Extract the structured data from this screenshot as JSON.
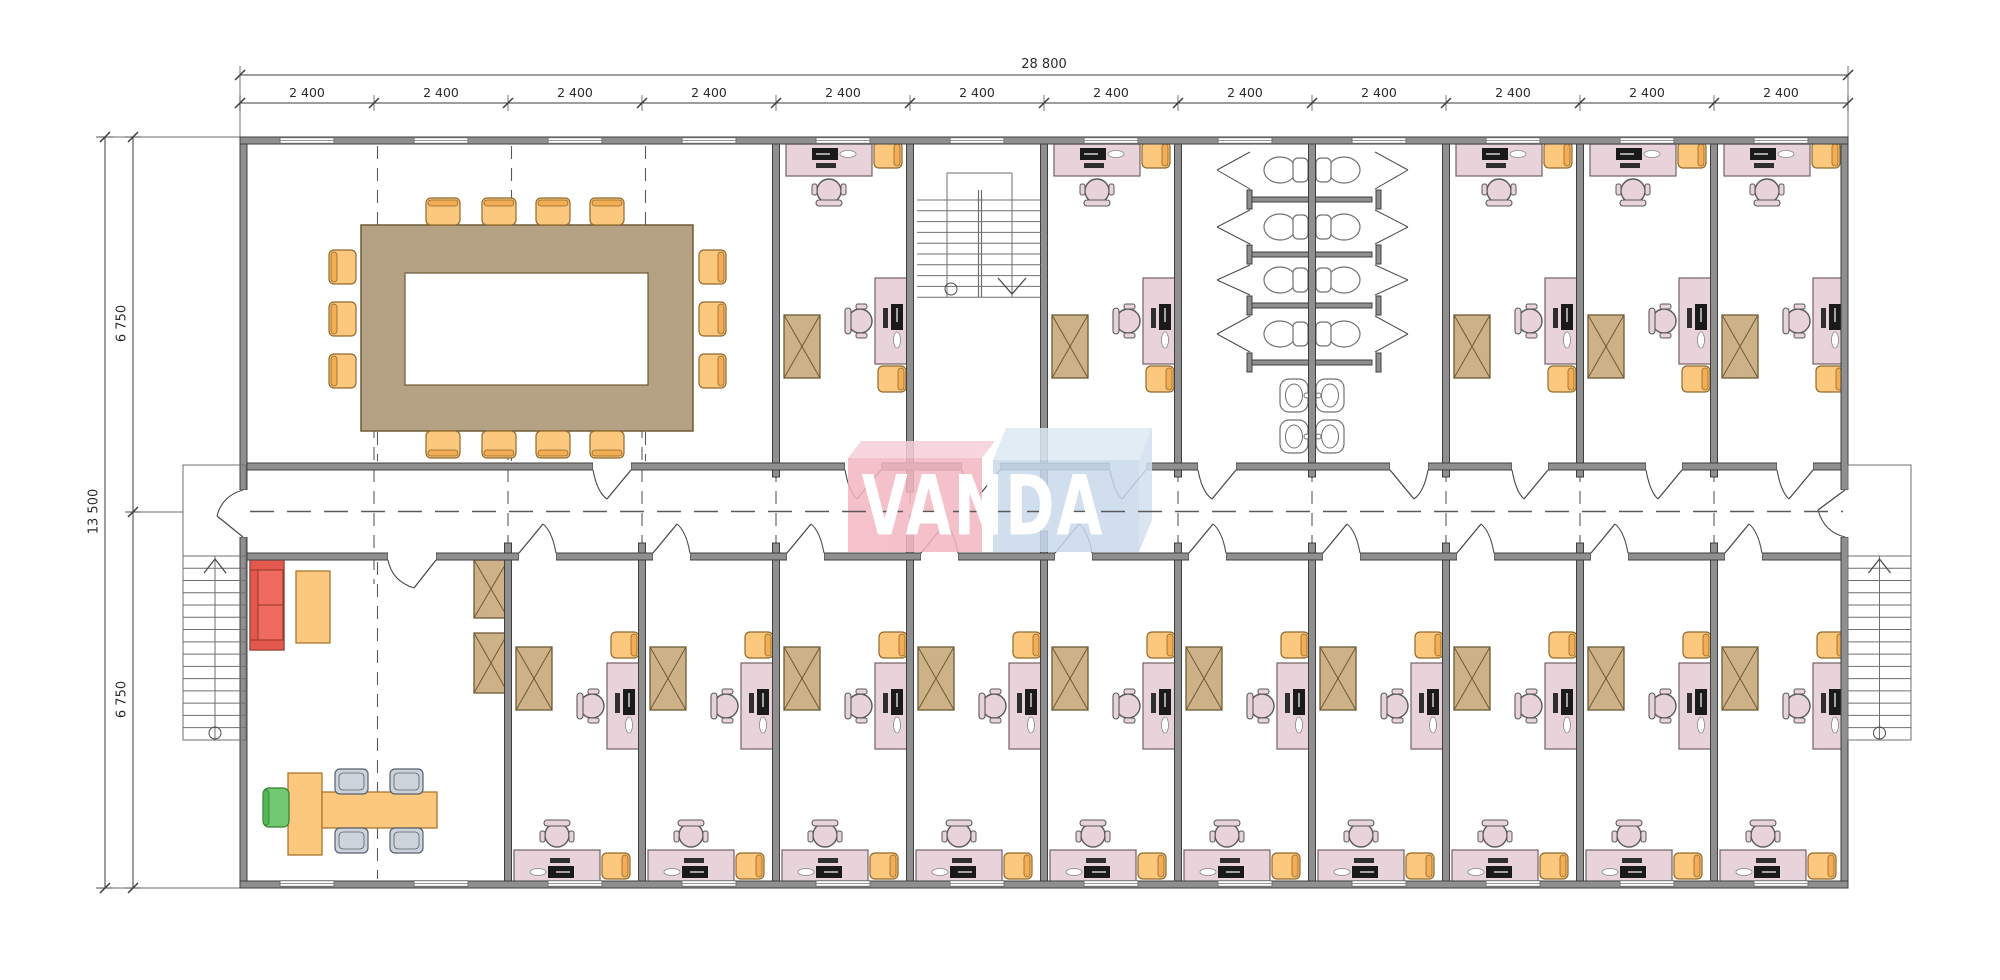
{
  "drawing": {
    "title": "Office floor plan",
    "logo": {
      "text": "VANDA"
    },
    "dimensions": {
      "top_total": "28 800",
      "top_modules": [
        "2 400",
        "2 400",
        "2 400",
        "2 400",
        "2 400",
        "2 400",
        "2 400",
        "2 400",
        "2 400",
        "2 400",
        "2 400",
        "2 400"
      ],
      "left_total": "13 500",
      "left_halves": [
        "6 750",
        "6 750"
      ]
    },
    "rooms": {
      "top_row": [
        "conference-room",
        "office",
        "stairwell",
        "office",
        "restrooms",
        "office",
        "office",
        "office"
      ],
      "bottom_row": [
        "reception-lounge",
        "office",
        "office",
        "office",
        "office",
        "office",
        "office",
        "office",
        "office",
        "office",
        "office"
      ]
    },
    "counts": {
      "structural_bays": 12,
      "toilet_stalls": 8,
      "sinks": 4,
      "conference_seats": 14,
      "offices": 15,
      "exterior_stairs": 2,
      "interior_stairs": 1
    }
  },
  "palette": {
    "wall": "#8f8f8f",
    "wall_edge": "#3f3f3f",
    "line": "#4a4a4a",
    "dash": "#5a5a5a",
    "desk": "#e7d3d9",
    "desk_edge": "#756066",
    "chair_yellow": "#fcc87e",
    "chair_yellow_band": "#f3ad55",
    "chair_yellow_edge": "#8f6a2e",
    "cabinet": "#cdb287",
    "cabinet_edge": "#6e5a35",
    "table_brown": "#b5a284",
    "table_edge": "#6e5a35",
    "sofa": "#ef6a5f",
    "sofa_dark": "#e4584d",
    "sofa_edge": "#8f352c",
    "orange": "#fcc87e",
    "orange_edge": "#a8762d",
    "green": "#72c972",
    "green_dark": "#57b457",
    "green_edge": "#2f7d2f",
    "gray_chair": "#ccd3db",
    "gray_chair_edge": "#55606b",
    "fixture_edge": "#707070",
    "stair_line": "#6f6f6f",
    "monitor": "#1a1a1a",
    "keyboard": "#2e2e2e",
    "logo_pink": "#f3b6c1",
    "logo_pink_top": "#f7d0d8",
    "logo_blue": "#c8d9ec",
    "logo_blue_top": "#dde9f4",
    "logo_blue_side": "#d3e0ef",
    "dim_text": "#2b2b2b"
  }
}
